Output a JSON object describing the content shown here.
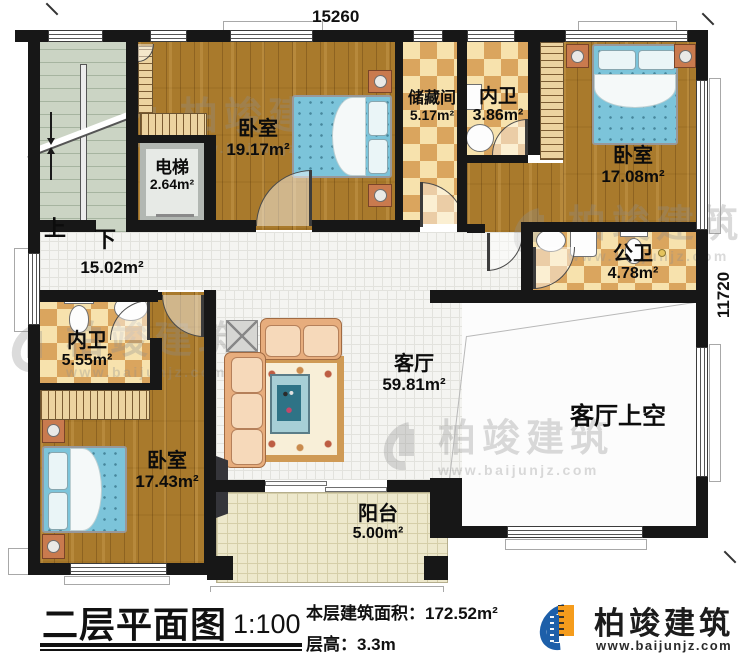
{
  "plan": {
    "dim_top": "15260",
    "dim_right": "11720",
    "stair_up": "上",
    "stair_down": "下",
    "hall_area": "15.02m²",
    "rooms": {
      "bedroom_top": {
        "name": "卧室",
        "area": "19.17m²"
      },
      "elevator": {
        "name": "电梯",
        "area": "2.64m²"
      },
      "storage": {
        "name": "储藏间",
        "area": "5.17m²"
      },
      "bath_top": {
        "name": "内卫",
        "area": "3.86m²"
      },
      "bedroom_right": {
        "name": "卧室",
        "area": "17.08m²"
      },
      "public_bath": {
        "name": "公卫",
        "area": "4.78m²"
      },
      "bath_left": {
        "name": "内卫",
        "area": "5.55m²"
      },
      "bedroom_bottom": {
        "name": "卧室",
        "area": "17.43m²"
      },
      "living": {
        "name": "客厅",
        "area": "59.81m²"
      },
      "living_void": {
        "name": "客厅上空"
      },
      "balcony": {
        "name": "阳台",
        "area": "5.00m²"
      }
    }
  },
  "titleblock": {
    "title": "二层平面图",
    "scale": "1:100",
    "floor_area": "本层建筑面积：172.52m²",
    "floor_height": "层高：3.3m"
  },
  "brand": {
    "name": "柏竣建筑",
    "website": "www.baijunjz.com"
  },
  "watermark": {
    "text": "柏竣建筑",
    "website": "www.baijunjz.com"
  },
  "colors": {
    "wall": "#171717",
    "wood_floor": "#a97a2c",
    "tile_checker": "#daa55e",
    "bed_blue": "#7cc4da",
    "stair_green": "#cbd4c4",
    "balcony_cream": "#ede8cc",
    "brand_blue": "#1d5fa9",
    "brand_orange": "#f59c1c"
  }
}
